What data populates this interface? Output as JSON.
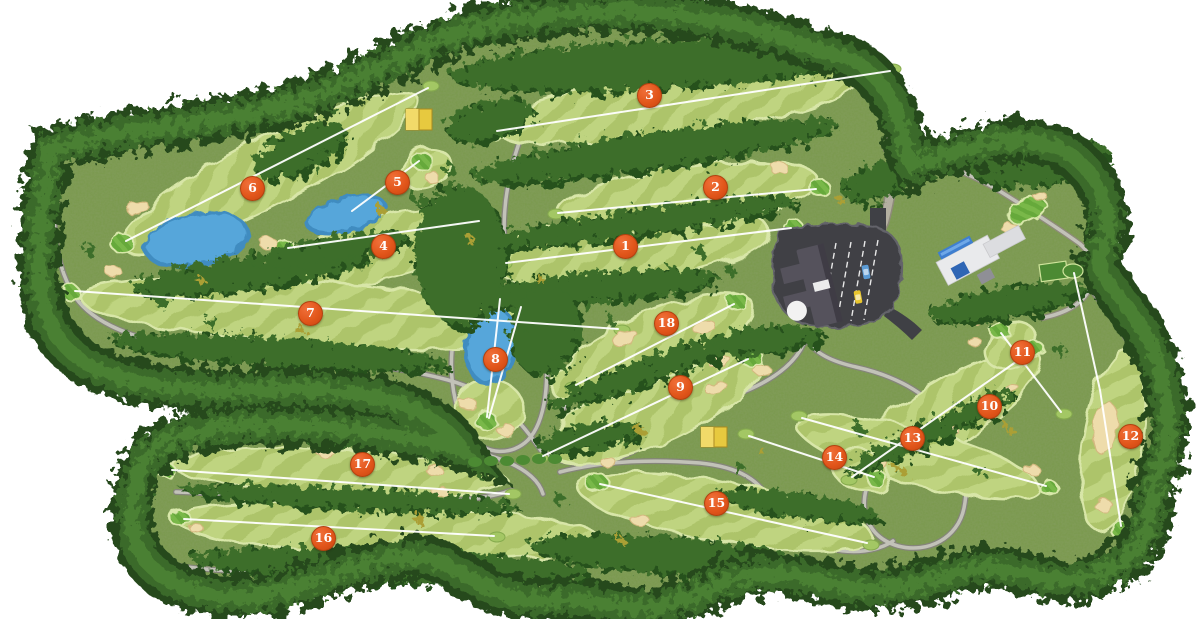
{
  "course_map": {
    "holes": [
      {
        "number": "1"
      },
      {
        "number": "2"
      },
      {
        "number": "3"
      },
      {
        "number": "4"
      },
      {
        "number": "5"
      },
      {
        "number": "6"
      },
      {
        "number": "7"
      },
      {
        "number": "8"
      },
      {
        "number": "9"
      },
      {
        "number": "10"
      },
      {
        "number": "11"
      },
      {
        "number": "12"
      },
      {
        "number": "13"
      },
      {
        "number": "14"
      },
      {
        "number": "15"
      },
      {
        "number": "16"
      },
      {
        "number": "17"
      },
      {
        "number": "18"
      }
    ],
    "colors": {
      "hole_badge": "#e2561b",
      "hole_badge_text": "#ffffff",
      "fairway_stripe_light": "#bfd480",
      "fairway_stripe_dark": "#adc46a",
      "putting_green": "#79b848",
      "rough": "#79994b",
      "forest": "#2e5a24",
      "autumn_foliage": "#ab9f35",
      "water": "#56a6da",
      "sand_bunker": "#eedcab",
      "cart_path": "#c2c2b8",
      "asphalt": "#3f4045",
      "rest_house": "#e7c93f",
      "hole_line": "#ffffff"
    }
  }
}
